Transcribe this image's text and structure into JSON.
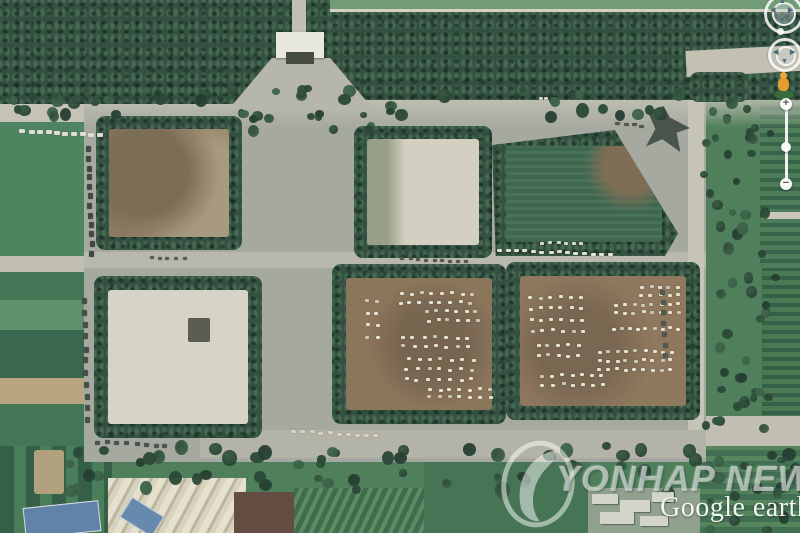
{
  "watermarks": {
    "yonhap_news": "YONHAP NEWS",
    "google_earth": "Google earth"
  },
  "nav_controls": {
    "zoom_in_label": "+",
    "zoom_out_label": "−"
  },
  "palette": {
    "forest": "#2d4b3a",
    "field_green": "#49815a",
    "pavement_gray": "#a6a89d",
    "dirt_brown": "#8a7156",
    "concrete_light": "#d7d4c6",
    "watermark_white": "rgba(255,255,255,0.52)",
    "pegman_orange": "#e89b30"
  },
  "scene": {
    "vehicle_clusters": [
      {
        "x": 400,
        "y": 292,
        "rows": 2,
        "cols": 8,
        "dx": 10,
        "dy": 9,
        "skew": -2
      },
      {
        "x": 424,
        "y": 310,
        "rows": 2,
        "cols": 6,
        "dx": 10,
        "dy": 9,
        "skew": 2
      },
      {
        "x": 400,
        "y": 336,
        "rows": 2,
        "cols": 7,
        "dx": 11,
        "dy": 9,
        "skew": 1
      },
      {
        "x": 406,
        "y": 358,
        "rows": 3,
        "cols": 7,
        "dx": 11,
        "dy": 10,
        "skew": -1
      },
      {
        "x": 428,
        "y": 388,
        "rows": 2,
        "cols": 7,
        "dx": 10,
        "dy": 8,
        "skew": 0
      },
      {
        "x": 366,
        "y": 300,
        "rows": 4,
        "cols": 2,
        "dx": 9,
        "dy": 12,
        "skew": 0
      },
      {
        "x": 640,
        "y": 286,
        "rows": 2,
        "cols": 5,
        "dx": 9,
        "dy": 8,
        "skew": 0
      },
      {
        "x": 614,
        "y": 303,
        "rows": 2,
        "cols": 8,
        "dx": 9,
        "dy": 8,
        "skew": 0
      },
      {
        "x": 528,
        "y": 296,
        "rows": 4,
        "cols": 6,
        "dx": 10,
        "dy": 11,
        "skew": 1
      },
      {
        "x": 612,
        "y": 327,
        "rows": 1,
        "cols": 9,
        "dx": 8,
        "dy": 9,
        "skew": 0
      },
      {
        "x": 536,
        "y": 344,
        "rows": 2,
        "cols": 5,
        "dx": 10,
        "dy": 10,
        "skew": 0
      },
      {
        "x": 598,
        "y": 350,
        "rows": 3,
        "cols": 9,
        "dx": 9,
        "dy": 9,
        "skew": -1
      },
      {
        "x": 540,
        "y": 374,
        "rows": 2,
        "cols": 7,
        "dx": 10,
        "dy": 9,
        "skew": 1
      }
    ],
    "vehicle_rows": [
      {
        "x": 497,
        "y": 249,
        "count": 14,
        "dx": 8.5,
        "dy": 0.3,
        "w": 5,
        "h": 3,
        "color": "#e6e2d2"
      },
      {
        "x": 540,
        "y": 242,
        "count": 6,
        "dx": 8,
        "dy": 0,
        "w": 4,
        "h": 3,
        "color": "#dcd8c8"
      },
      {
        "x": 20,
        "y": 129,
        "count": 10,
        "dx": 8.5,
        "dy": 0.5,
        "w": 6,
        "h": 4,
        "color": "#e3e0d2"
      },
      {
        "x": 292,
        "y": 430,
        "count": 10,
        "dx": 9,
        "dy": 0.5,
        "w": 5,
        "h": 3,
        "color": "#d8d5c6"
      },
      {
        "x": 96,
        "y": 440,
        "count": 8,
        "dx": 9.5,
        "dy": 0.5,
        "w": 5,
        "h": 4,
        "color": "#454f49"
      },
      {
        "x": 86,
        "y": 146,
        "count": 12,
        "dx": 0.3,
        "dy": 9.5,
        "w": 5,
        "h": 6,
        "color": "#3a443e"
      },
      {
        "x": 82,
        "y": 298,
        "count": 11,
        "dx": 0.3,
        "dy": 12,
        "w": 5,
        "h": 6,
        "color": "#3f4a43"
      },
      {
        "x": 660,
        "y": 290,
        "count": 7,
        "dx": 0.5,
        "dy": 10.5,
        "w": 5,
        "h": 5,
        "color": "#49544c"
      },
      {
        "x": 616,
        "y": 122,
        "count": 4,
        "dx": 8,
        "dy": 1,
        "w": 5,
        "h": 3,
        "color": "#4a5350"
      },
      {
        "x": 538,
        "y": 98,
        "count": 3,
        "dx": 7,
        "dy": 0,
        "w": 4,
        "h": 3,
        "color": "#d8d4c4"
      },
      {
        "x": 150,
        "y": 256,
        "count": 5,
        "dx": 8,
        "dy": 0.5,
        "w": 4,
        "h": 3,
        "color": "#50584e"
      },
      {
        "x": 400,
        "y": 257,
        "count": 9,
        "dx": 8,
        "dy": 0.4,
        "w": 4,
        "h": 3,
        "color": "#4a5248"
      }
    ],
    "tree_bands": [
      {
        "x": 0,
        "y": 84,
        "w": 695,
        "h": 28,
        "count": 48,
        "rmin": 7,
        "rmax": 13
      },
      {
        "x": 238,
        "y": 106,
        "w": 130,
        "h": 26,
        "count": 11,
        "rmin": 6,
        "rmax": 11
      },
      {
        "x": 52,
        "y": 440,
        "w": 745,
        "h": 48,
        "count": 64,
        "rmin": 8,
        "rmax": 15
      },
      {
        "x": 700,
        "y": 96,
        "w": 68,
        "h": 168,
        "count": 26,
        "rmin": 7,
        "rmax": 12
      },
      {
        "x": 700,
        "y": 262,
        "w": 72,
        "h": 162,
        "count": 26,
        "rmin": 7,
        "rmax": 12
      },
      {
        "x": 700,
        "y": 448,
        "w": 100,
        "h": 78,
        "count": 12,
        "rmin": 7,
        "rmax": 12
      }
    ],
    "building_patches": [
      {
        "x": 592,
        "y": 494,
        "w": 26,
        "h": 10
      },
      {
        "x": 620,
        "y": 500,
        "w": 30,
        "h": 12
      },
      {
        "x": 652,
        "y": 492,
        "w": 22,
        "h": 10
      },
      {
        "x": 600,
        "y": 512,
        "w": 34,
        "h": 12
      },
      {
        "x": 640,
        "y": 516,
        "w": 28,
        "h": 10
      }
    ]
  }
}
